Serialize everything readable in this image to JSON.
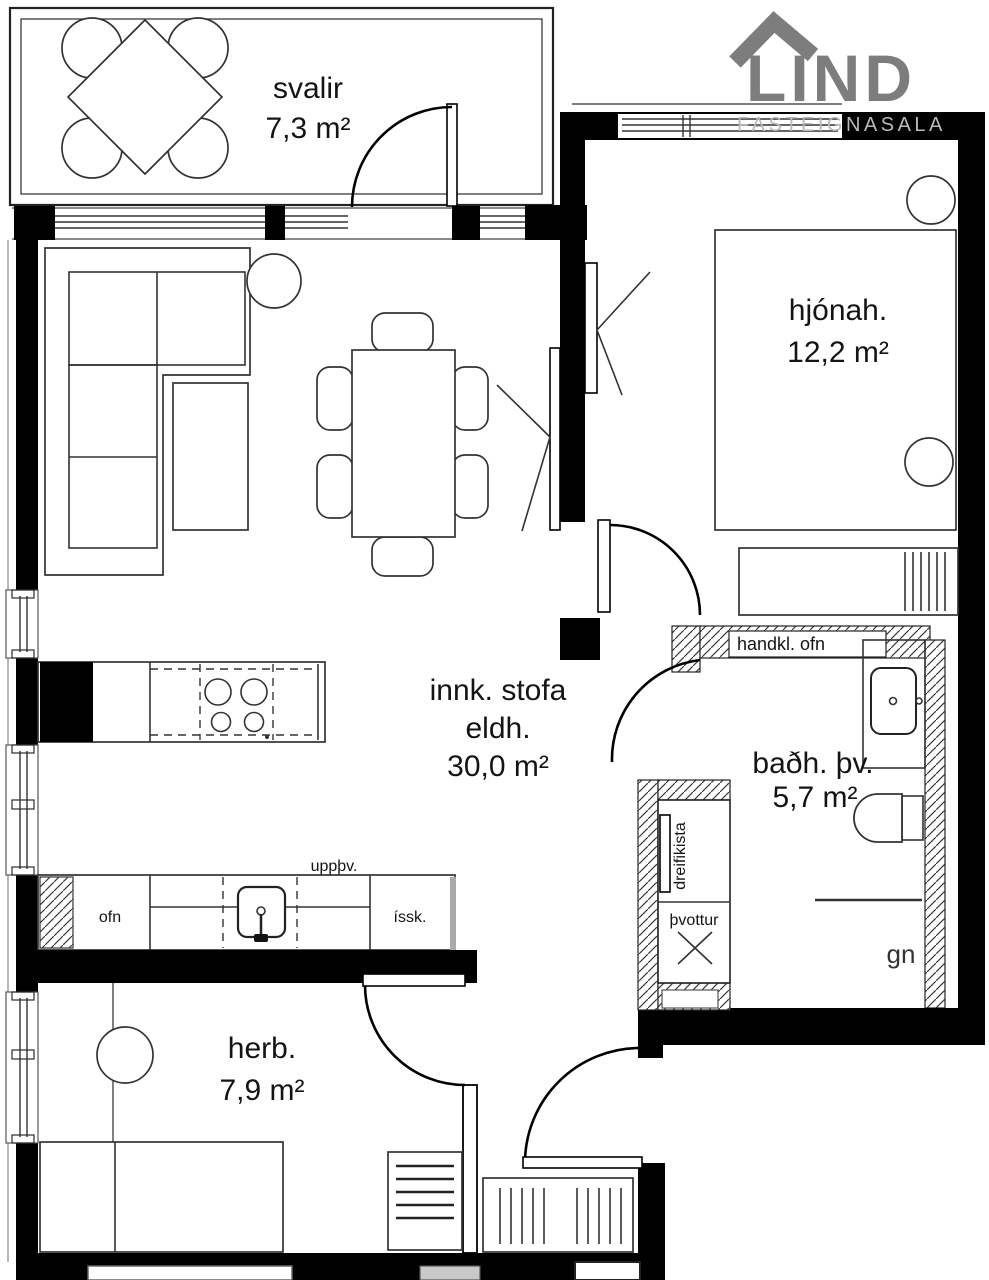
{
  "plan": {
    "rooms": [
      {
        "name": "svalir",
        "area": "7,3 m²"
      },
      {
        "name": "hjónah.",
        "area": "12,2 m²"
      },
      {
        "name_line1": "innk. stofa",
        "name_line2": "eldh.",
        "area": "30,0 m²"
      },
      {
        "name": "baðh. þv.",
        "area": "5,7 m²"
      },
      {
        "name": "herb.",
        "area": "7,9 m²"
      }
    ],
    "fixtures": {
      "towel_radiator": "handkl. ofn",
      "distribution_box": "dreifikista",
      "washing": "þvottur",
      "oven": "ofn",
      "fridge": "íssk.",
      "dishwasher": "uppþv.",
      "drain": "gn"
    },
    "colors": {
      "wall": "#000000",
      "line": "#2b2b2b",
      "logo_gray": "#7d7d7d",
      "logo_light_gray": "#b9b9b9"
    }
  },
  "logo": {
    "brand": "LIND",
    "subtitle": "FASTEIGNASALA"
  }
}
